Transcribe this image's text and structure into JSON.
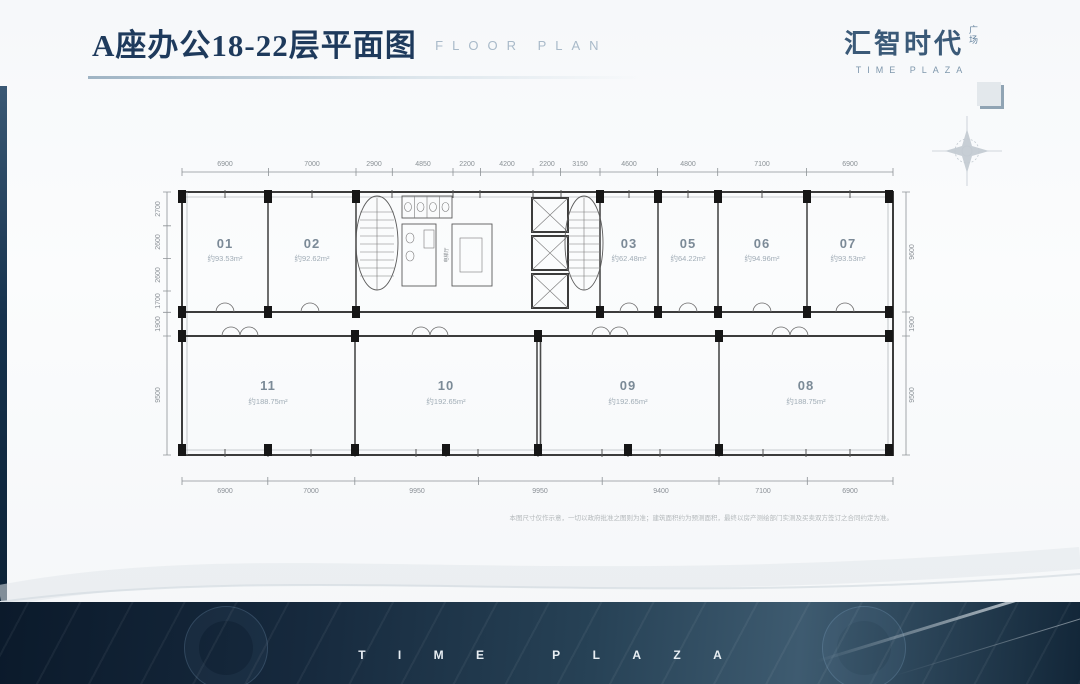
{
  "header": {
    "title": "A座办公18-22层平面图",
    "subtitle": "FLOOR PLAN"
  },
  "brand": {
    "name_cn": "汇智时代",
    "name_suffix": "广场",
    "name_en": "TIME PLAZA"
  },
  "plan": {
    "rooms_top": [
      {
        "id": "01",
        "area": "约93.53m²"
      },
      {
        "id": "02",
        "area": "约92.62m²"
      },
      {
        "id": "03",
        "area": "约62.48m²"
      },
      {
        "id": "05",
        "area": "约64.22m²"
      },
      {
        "id": "06",
        "area": "约94.96m²"
      },
      {
        "id": "07",
        "area": "约93.53m²"
      }
    ],
    "rooms_bottom": [
      {
        "id": "11",
        "area": "约188.75m²"
      },
      {
        "id": "10",
        "area": "约192.65m²"
      },
      {
        "id": "09",
        "area": "约192.65m²"
      },
      {
        "id": "08",
        "area": "约188.75m²"
      }
    ],
    "dims_top": [
      "6900",
      "7000",
      "2900",
      "4850",
      "2200",
      "4200",
      "2200",
      "3150",
      "4600",
      "4800",
      "7100",
      "6900"
    ],
    "dims_bottom": [
      "6900",
      "7000",
      "9950",
      "9950",
      "9400",
      "7100",
      "6900"
    ],
    "dims_left": [
      "2700",
      "2600",
      "2600",
      "1700",
      "1900",
      "9500"
    ],
    "dims_right": [
      "9600",
      "1900",
      "9500"
    ],
    "core_label": "电梯厅",
    "disclaimer": "本图尺寸仅作示意，一切以政府批准之图则为准；建筑面积约为预测面积，最终以房产测绘部门实测及买卖双方签订之合同约定为准。"
  },
  "footer": {
    "watermark": "TIME PLAZA"
  }
}
